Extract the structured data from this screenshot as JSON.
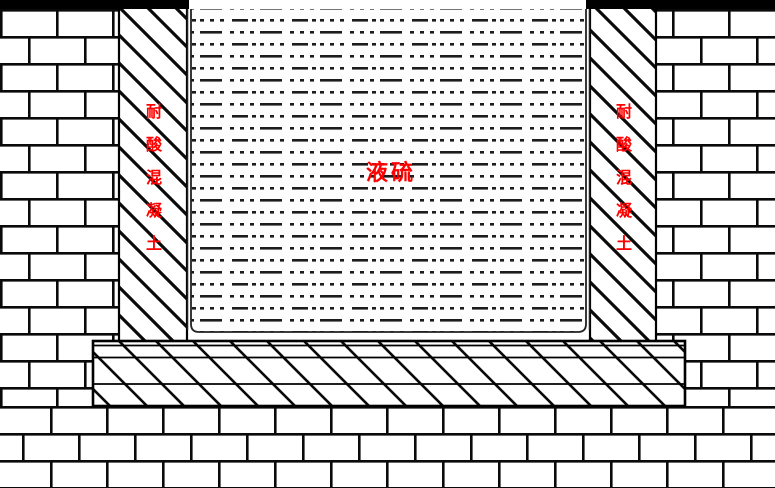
{
  "diagram": {
    "labels": {
      "left_column": "耐酸混凝土",
      "liquid": "液硫",
      "right_column": "耐酸混凝土"
    },
    "colors": {
      "label_red": "#ff0000",
      "line_black": "#000000",
      "background": "#ffffff"
    }
  }
}
